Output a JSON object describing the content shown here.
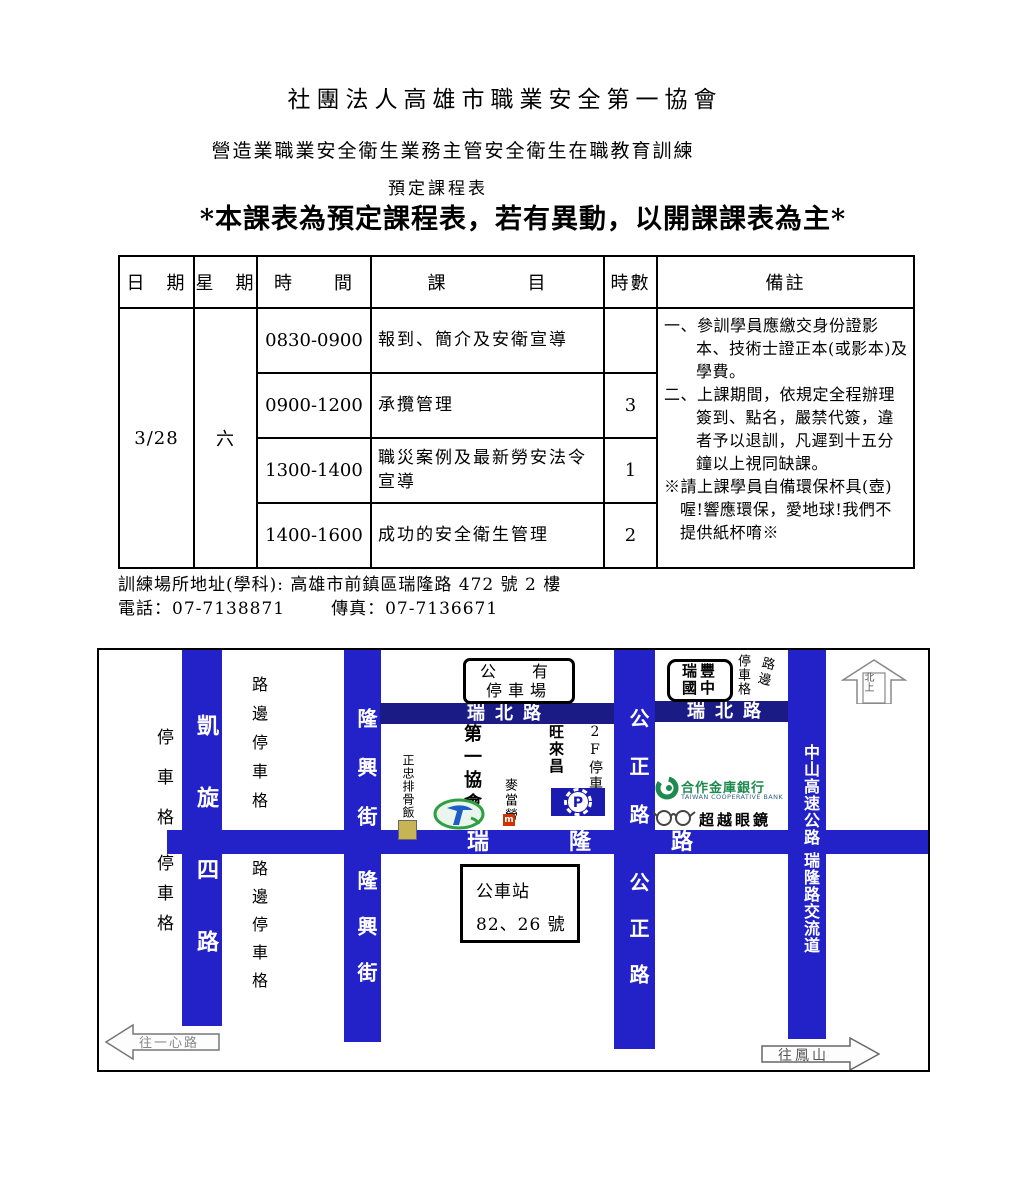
{
  "document": {
    "org_title": "社團法人高雄市職業安全第一協會",
    "course_title": "營造業職業安全衛生業務主管安全衛生在職教育訓練",
    "schedule_label": "預定課程表",
    "notice": "*本課表為預定課程表，若有異動，以開課課表為主*"
  },
  "table": {
    "headers": {
      "date": "日　期",
      "weekday": "星　期",
      "time": "時　　間",
      "subject": "課　　　　目",
      "hours": "時數",
      "remarks": "備註"
    },
    "date": "3/28",
    "weekday": "六",
    "rows": [
      {
        "time": "0830-0900",
        "subject": "報到、簡介及安衛宣導",
        "hours": ""
      },
      {
        "time": "0900-1200",
        "subject": "承攬管理",
        "hours": "3"
      },
      {
        "time": "1300-1400",
        "subject": "職災案例及最新勞安法令宣導",
        "hours": "1"
      },
      {
        "time": "1400-1600",
        "subject": "成功的安全衛生管理",
        "hours": "2"
      }
    ],
    "remarks": [
      "一、參訓學員應繳交身份證影本、技術士證正本(或影本)及學費。",
      "二、上課期間，依規定全程辦理簽到、點名，嚴禁代簽，違者予以退訓，凡遲到十五分鐘以上視同缺課。",
      "※請上課學員自備環保杯具(壺)喔!響應環保，愛地球!我們不提供紙杯唷※"
    ]
  },
  "contact": {
    "address": "訓練場所地址(學科): 高雄市前鎮區瑞隆路 472 號 2 樓",
    "phone": "電話：07-7138871",
    "fax": "傳真：07-7136671"
  },
  "map": {
    "labels": {
      "kaixuan_top": "凱旋",
      "kaixuan_bottom": "四路",
      "longxing_top": "隆興街",
      "longxing_bottom": "隆興街",
      "gongzheng_top": "公正路",
      "gongzheng_bottom": "公正路",
      "zhongshan": "中山高速公路",
      "ruilong_interchange": "瑞隆路交流道",
      "ruibei_left": "瑞北路",
      "ruibei_right": "瑞北路",
      "ruilong_main": "瑞隆路",
      "parking_left_top": "停車格",
      "parking_left_bottom": "停車格",
      "roadside_left_top": "路邊停車格",
      "roadside_left_bottom": "路邊停車格",
      "roadside_right_side": "路邊",
      "roadside_right_stall": "停車格",
      "public_parking_line1": "公　有",
      "public_parking_line2": "停車場",
      "ruifeng_line1": "瑞豐",
      "ruifeng_line2": "國中",
      "north_arrow": "北上",
      "first_assoc": "第一協會",
      "zhengzhong": "正忠排骨飯",
      "mcdonalds": "麥當勞",
      "mcdonalds_m": "m",
      "wanglaichang": "旺來昌",
      "parking_2f": "2F停車場",
      "p_symbol": "P",
      "coop_bank": "合作金庫銀行",
      "coop_bank_en": "TAIWAN COOPERATIVE BANK",
      "glasses_shop": "超越眼鏡",
      "bus_stop_line1": "公車站",
      "bus_stop_line2": "82、26 號",
      "arrow_left": "往一心路",
      "arrow_right": "往鳳山"
    }
  }
}
